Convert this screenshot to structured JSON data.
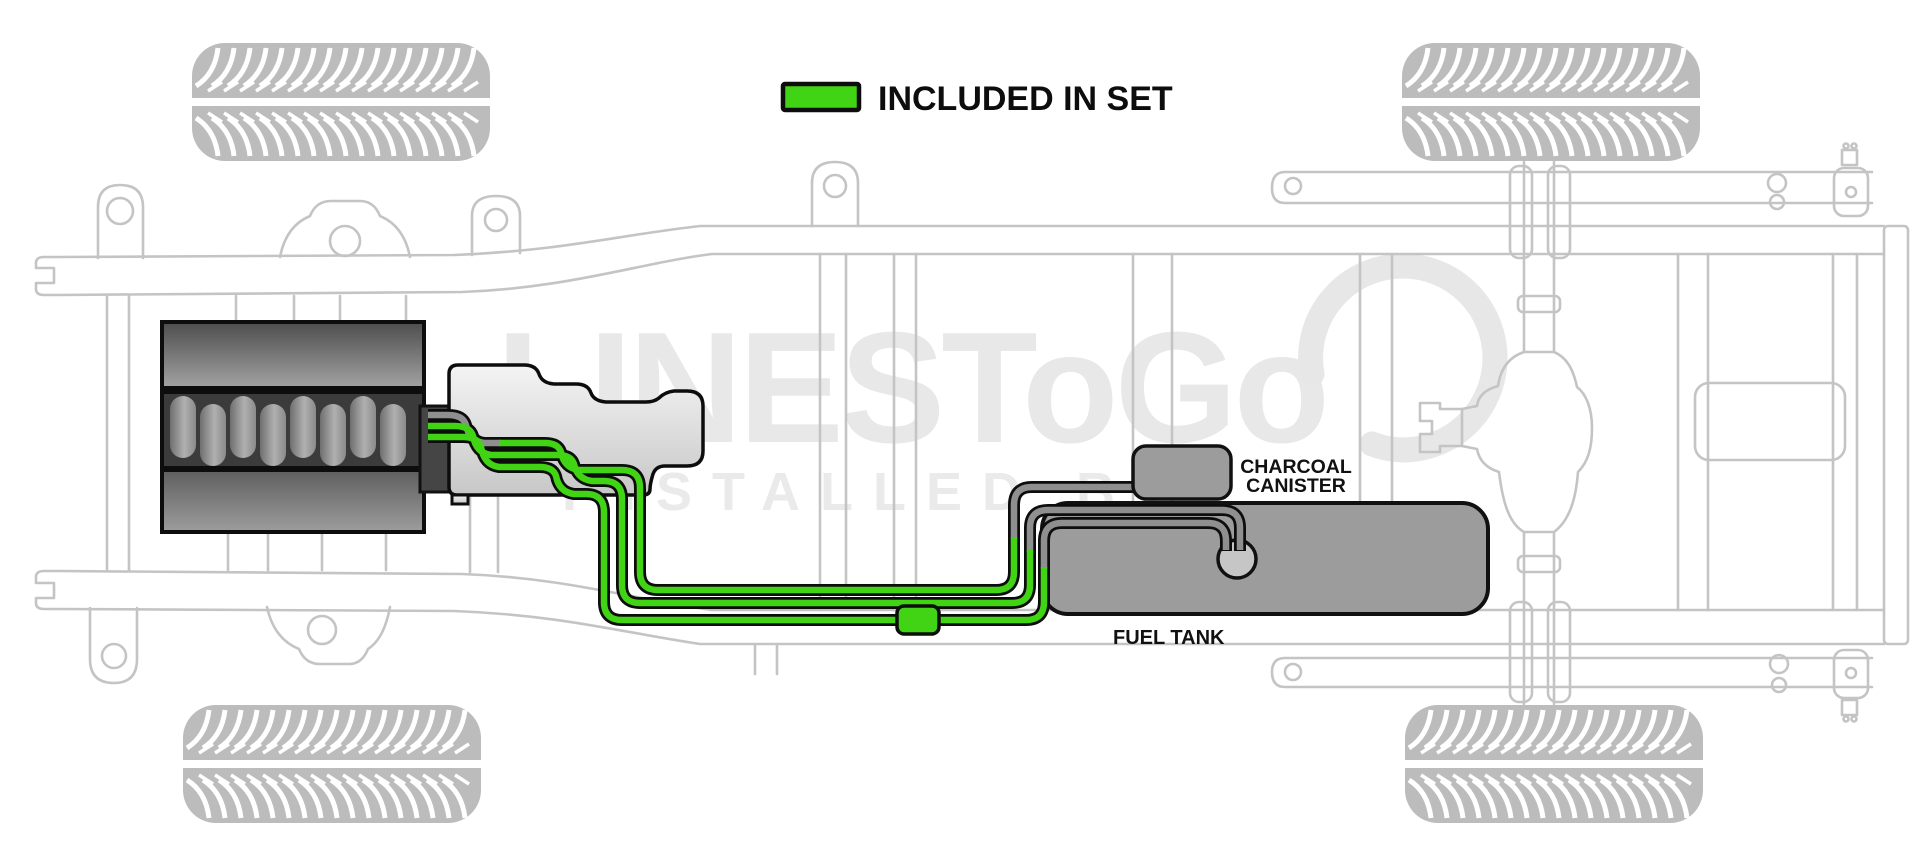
{
  "legend": {
    "label": "INCLUDED IN SET",
    "swatch_color": "#41d414"
  },
  "diagram": {
    "charcoal_canister_label_line1": "CHARCOAL",
    "charcoal_canister_label_line2": "CANISTER",
    "fuel_tank_label": "FUEL TANK",
    "included_line_color": "#41d414",
    "not_included_line_color": "#8f8f8f"
  },
  "watermark": {
    "brand": "LINESToGo",
    "tagline": "INSTALLED BY"
  }
}
